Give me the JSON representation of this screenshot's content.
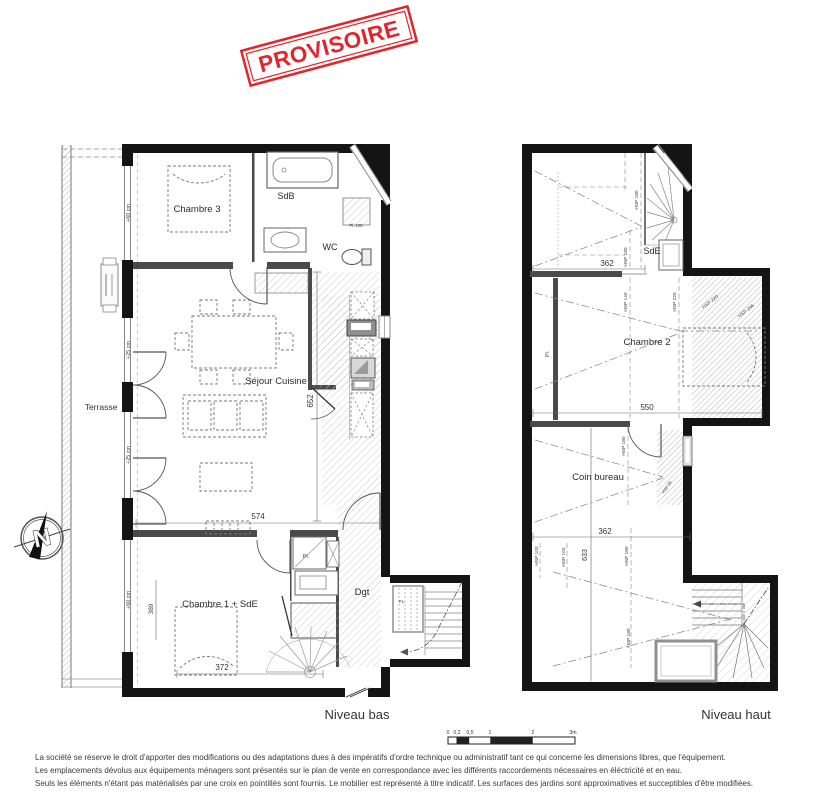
{
  "stamp": {
    "text": "PROVISOIRE"
  },
  "colors": {
    "stamp_red": "#e4232b"
  },
  "plan_bas": {
    "title": "Niveau bas",
    "rooms": {
      "chambre3": "Chambre 3",
      "sdb": "SdB",
      "wc": "WC",
      "pl105": "Pl. 105",
      "sejour": "Séjour Cuisine",
      "terrasse": "Terrasse",
      "chambre1": "Chambre 1 + SdE",
      "dgt": "Dgt",
      "pl_entry": "Pl.",
      "pl_stair": "PL."
    },
    "dims": {
      "w574": "574",
      "w372": "372",
      "h652": "652",
      "h389": "389",
      "win60_top": "+60 cm",
      "win25_mid": "+25 cm",
      "win25_low": "+25 cm",
      "win60_bot": "+60 cm"
    }
  },
  "plan_haut": {
    "title": "Niveau haut",
    "rooms": {
      "sde": "SdE",
      "chambre2": "Chambre 2",
      "coin_bureau": "Coin bureau",
      "pl": "Pl."
    },
    "dims": {
      "w362_top": "362",
      "w550": "550",
      "w362_bot": "362",
      "h633": "633"
    },
    "hsp": {
      "sde_a": "HSP 180",
      "sde_b": "HSP 180",
      "ch2_140": "HSP 140",
      "ch2_220": "HSP 220",
      "ch2_220d": "HSP 220",
      "ch2_246d": "HSP 246",
      "coin_180": "HSP 180",
      "coin_95": "HSP 95",
      "low_103": "HSP 103",
      "low_104": "HSP 104",
      "low_180a": "HSP 180",
      "low_180b": "HSP 180"
    }
  },
  "compass": {
    "letter": "N"
  },
  "scalebar": {
    "t0": "0",
    "t02": "0,2",
    "t05": "0,5",
    "t1": "1",
    "t2": "2",
    "t3": "3m"
  },
  "footer": {
    "line1": "La société se réserve le droit  d'apporter des modifications ou des adaptations dues à des impératifs d'ordre technique ou administratif tant ce qui concerne les dimensions libres, que l'équipement.",
    "line2": "Les emplacements dévolus aux équipements ménagers sont présentés sur le plan de vente en correspondance avec les différents raccordements nécessaires en éléctricité et en eau.",
    "line3": "Seuls les éléments n'étant pas matérialisés par une croix en pointillés sont fournis. Le mobilier est représenté à titre indicatif. Les surfaces des jardins sont approximatives et succeptibles d'être modifiées."
  }
}
